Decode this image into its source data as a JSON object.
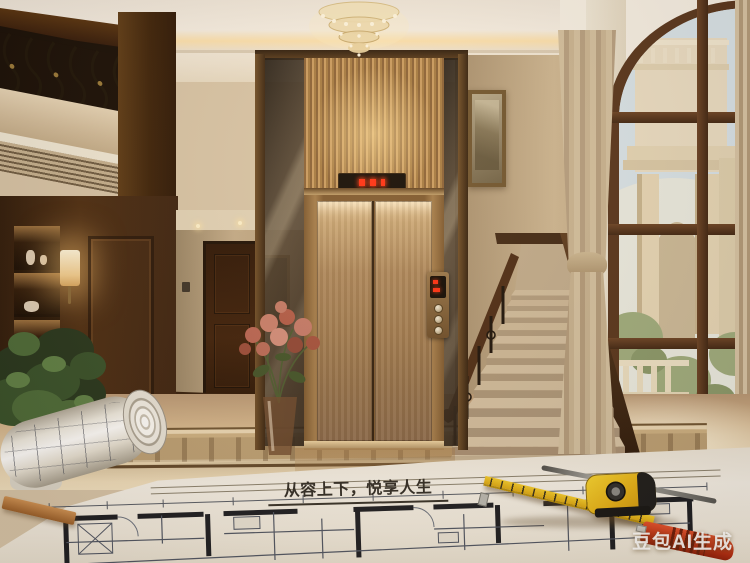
{
  "overlay": {
    "slogan": "从容上下，悦享人生",
    "watermark": "豆包AI生成"
  },
  "elevator": {
    "led_color": "#ff2d12",
    "door_finish_color": "#b08d5f",
    "call_panel_buttons": 3
  },
  "palette": {
    "bronze_light": "#dfc094",
    "bronze": "#a87c48",
    "bronze_dark": "#6e4d28",
    "wood_dark": "#3a2110",
    "wall_beige": "#c4ad8c",
    "marble_floor": "#e9d4b0",
    "inlay_brown": "#5c4226",
    "sky": "#dae7ee",
    "paper": "#f6f2ea",
    "blueprint_ink": "#2f3540",
    "tape_yellow": "#edc41f",
    "knife_red": "#c03a1e",
    "plant_green": "#3e5a30"
  },
  "scene": {
    "setting": "luxury duplex foyer with glass home elevator, marble staircase, arched window and architectural blueprints in foreground",
    "objects": [
      "crystal-chandelier",
      "wrought-iron-balcony-railing",
      "display-cabinet",
      "wall-sconce",
      "interior-door",
      "framed-artwork",
      "flower-vase",
      "potted-plant",
      "glass-elevator-shaft",
      "bronze-elevator-doors",
      "elevator-floor-display",
      "elevator-call-panel",
      "marble-staircase",
      "stair-iron-railing",
      "framed-painting",
      "tied-curtain",
      "arched-window",
      "exterior-columns",
      "marble-floor-inlay",
      "architectural-blueprint",
      "rolled-blueprint",
      "wooden-ruler",
      "steel-ruler",
      "measuring-tape",
      "utility-knife"
    ]
  }
}
